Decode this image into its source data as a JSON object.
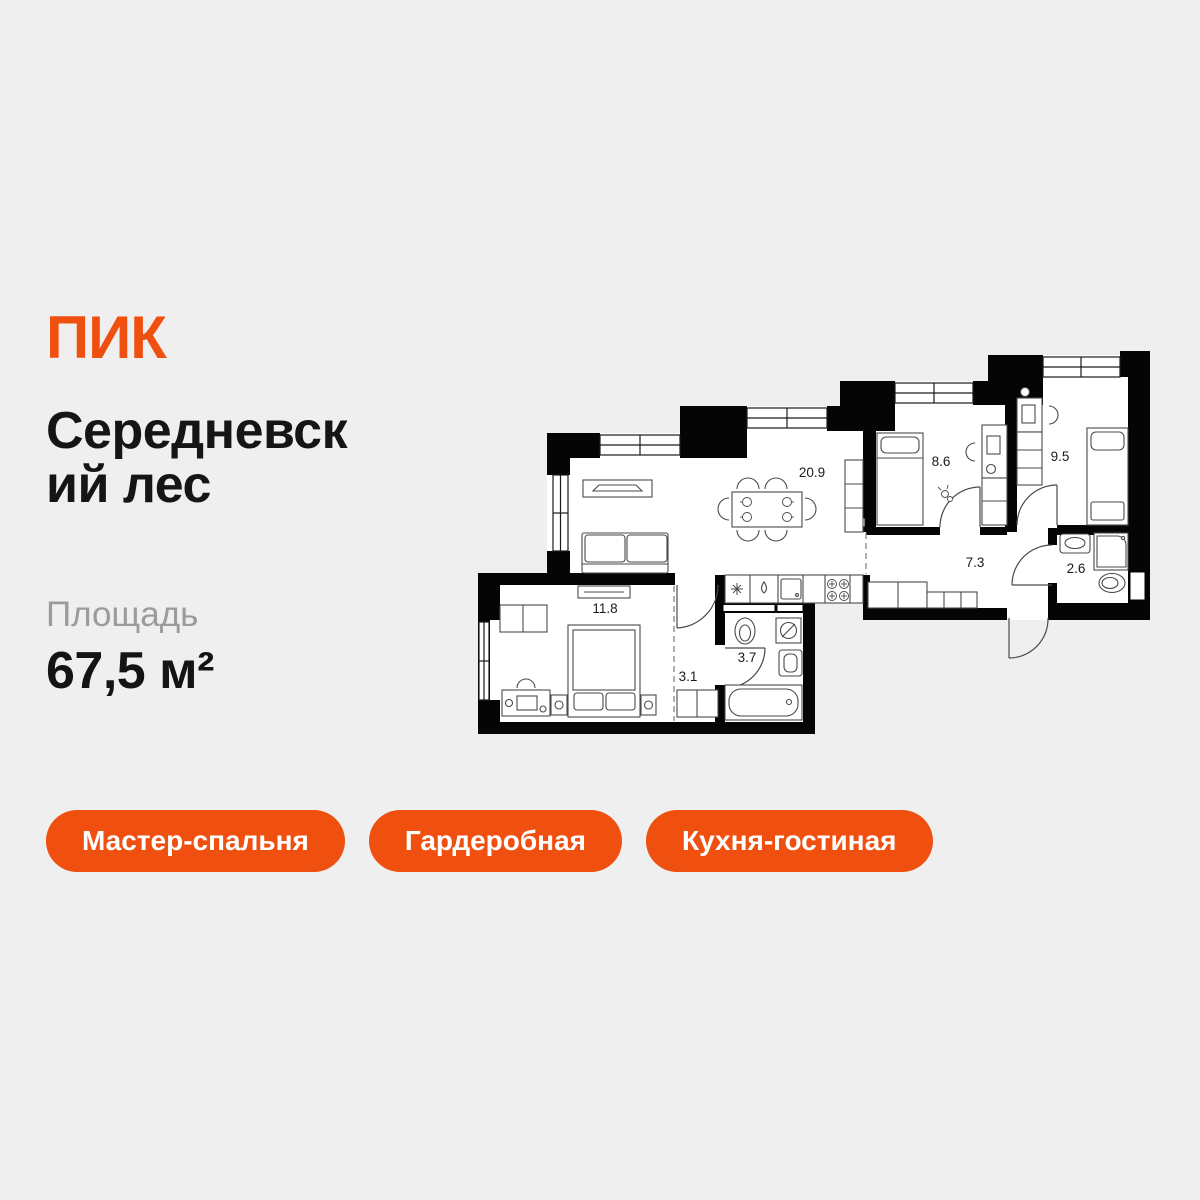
{
  "brand": {
    "logo_text": "ПИК"
  },
  "project": {
    "name": "Середневский лес",
    "title_lines": [
      "Середневск",
      "ий лес"
    ]
  },
  "area": {
    "label": "Площадь",
    "value": "67,5 м²"
  },
  "badges": [
    {
      "label": "Мастер-спальня"
    },
    {
      "label": "Гардеробная"
    },
    {
      "label": "Кухня-гостиная"
    }
  ],
  "floorplan": {
    "rooms": [
      {
        "name": "kitchen-living-room",
        "area": "20.9"
      },
      {
        "name": "bedroom-2",
        "area": "8.6"
      },
      {
        "name": "bedroom-3",
        "area": "9.5"
      },
      {
        "name": "hallway",
        "area": "7.3"
      },
      {
        "name": "bathroom-small",
        "area": "2.6"
      },
      {
        "name": "master-bedroom",
        "area": "11.8"
      },
      {
        "name": "corridor",
        "area": "3.1"
      },
      {
        "name": "bathroom",
        "area": "3.7"
      }
    ]
  },
  "colors": {
    "accent": "#F0500F",
    "background": "#EFEFEF",
    "walls": "#000000",
    "muted_text": "#9B9B9B"
  }
}
